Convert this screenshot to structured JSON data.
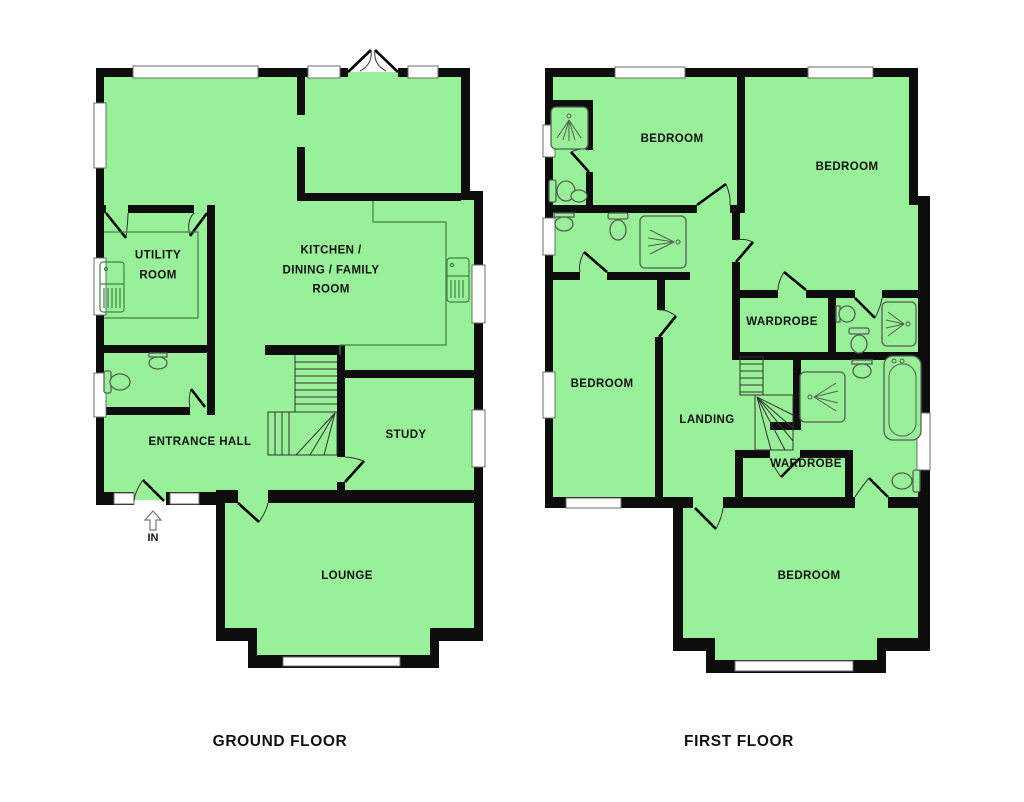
{
  "colors": {
    "floor_fill": "#98F098",
    "wall": "#0d0d0d",
    "fixture": "#44804a",
    "sanitary": "#556055",
    "window_fill": "#ffffff",
    "window_stroke": "#6b6b6b",
    "label": "#111111"
  },
  "ground_floor": {
    "title": "GROUND FLOOR",
    "entrance_label": "IN",
    "rooms": [
      {
        "id": "utility-room",
        "label": "UTILITY ROOM"
      },
      {
        "id": "kitchen-dining-family-room",
        "label": "KITCHEN / DINING / FAMILY ROOM"
      },
      {
        "id": "entrance-hall",
        "label": "ENTRANCE HALL"
      },
      {
        "id": "study",
        "label": "STUDY"
      },
      {
        "id": "lounge",
        "label": "LOUNGE"
      }
    ]
  },
  "first_floor": {
    "title": "FIRST FLOOR",
    "rooms": [
      {
        "id": "bedroom-top-left",
        "label": "BEDROOM"
      },
      {
        "id": "bedroom-top-right",
        "label": "BEDROOM"
      },
      {
        "id": "bedroom-mid-left",
        "label": "BEDROOM"
      },
      {
        "id": "landing",
        "label": "LANDING"
      },
      {
        "id": "wardrobe-upper",
        "label": "WARDROBE"
      },
      {
        "id": "wardrobe-lower",
        "label": "WARDROBE"
      },
      {
        "id": "bedroom-bottom",
        "label": "BEDROOM"
      }
    ]
  }
}
